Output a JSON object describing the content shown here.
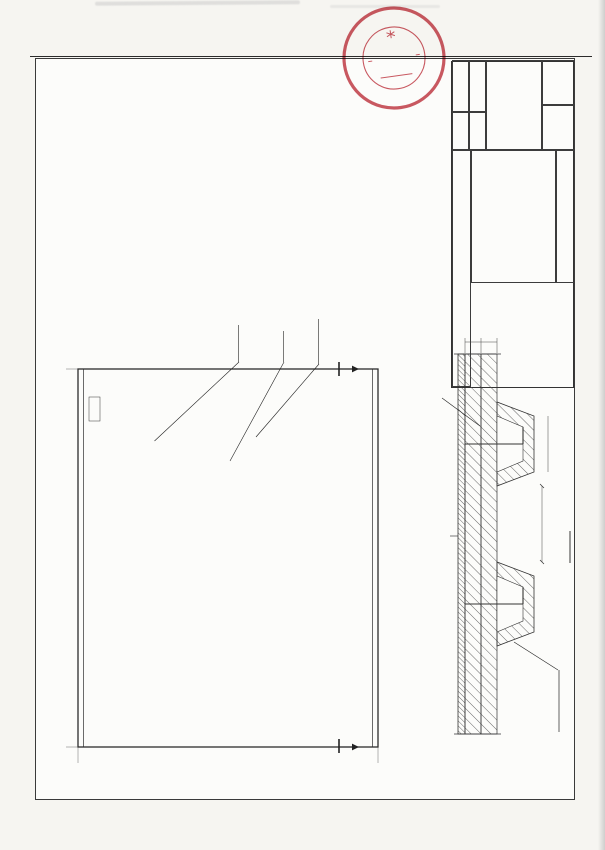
{
  "page": {
    "header_title": "Annex to the Certificate No.TA171235E(N)"
  },
  "stamp": {
    "arc_top": "NIPPON KAIJI KYOKAI",
    "arc_bottom": "ClassNK",
    "monogram": "NK",
    "color": "#c23b46"
  },
  "notes": {
    "lines": [
      "Description:",
      "1.Fireproof Materials:MJF-I Marine formaldehyde-free",
      "composite aluminum blanket,(3600*610*30)mm*Double,96Kg/m³.",
      "Fixed:When installing,fixed with welded pin and the two",
      "layers are staggered(joints),staggered-joints≥150mm.",
      "2.Welded pin specification:Φ3*80mm,Q235 Copper plating.",
      "Locking sheet:Φ30*0.1mm,Q235 Galvanized.",
      "3.Welded pin max spacing is 350mm,and maximum spacing from",
      "adjacent connection points is 150mm.Spacing with stiffeners",
      "is 100-150mm.",
      "4.Welded pin fixation:welding.Quality:17-21 sets/m².",
      "5.IMO.2010 FTP Annex 1 Part 3."
    ]
  },
  "plan": {
    "labels": {
      "outside_1": "Outside",
      "outside_2": "Joints",
      "inside_1": "Inside",
      "inside_2": "Joints",
      "welded_pin": "Welded pin"
    },
    "corners": {
      "top_left": "A",
      "top_right": "D",
      "bottom_left": "C",
      "bottom_right": "B"
    },
    "section_mark": "A",
    "dims": {
      "width_total": "3880",
      "height_total": "2480",
      "top_chain": [
        "150",
        "150",
        "250",
        "265",
        "325",
        "265",
        "325",
        "265",
        "325",
        "265",
        "250",
        "150",
        "150"
      ],
      "left_chain": [
        "40",
        "150",
        "200",
        "200",
        "250",
        "200",
        "200",
        "250",
        "200",
        "250",
        "200",
        "150",
        "150",
        "40"
      ],
      "local_top": "200",
      "local_top2": "150",
      "local_bottom": [
        "150",
        "500",
        "100"
      ]
    },
    "pins": {
      "col_fr": [
        0.018,
        0.098,
        0.178,
        0.258,
        0.338,
        0.418,
        0.498,
        0.578,
        0.658,
        0.738,
        0.818,
        0.898,
        0.982
      ],
      "row_fr": [
        0.016,
        0.07,
        0.158,
        0.245,
        0.332,
        0.418,
        0.5,
        0.582,
        0.668,
        0.755,
        0.842,
        0.93,
        0.984
      ]
    },
    "thermocouples": [
      {
        "n": "1",
        "x": 96,
        "y": 170
      },
      {
        "n": "2",
        "x": 322,
        "y": 96,
        "dim": "100"
      },
      {
        "n": "3",
        "x": 150,
        "y": 166
      },
      {
        "n": "4",
        "x": 205,
        "y": 158
      },
      {
        "n": "5",
        "x": 258,
        "y": 148,
        "dim": "130"
      },
      {
        "n": "6",
        "x": 136,
        "y": 104
      },
      {
        "n": "7",
        "x": 282,
        "y": 132
      },
      {
        "n": "8",
        "x": 242,
        "y": 110,
        "dim": "100"
      },
      {
        "n": "9",
        "x": 95,
        "y": 104
      }
    ]
  },
  "bom": {
    "headers": {
      "no": "No.",
      "model": "Model/Drawing",
      "name": "Name&Specification",
      "remarks": "Remarks"
    },
    "rows": [
      {
        "no": "11",
        "name": "Marine formaldehyde-free composite",
        "sub": "aluminum blanket 2x20mm"
      },
      {
        "no": "10",
        "name": "Welded pin:Φ3x80",
        "sub": "Locking sheet:Φ30x0.1 Q235"
      },
      {
        "no": "9",
        "name": "Temperature measuring point",
        "sub": "Thermocouple"
      },
      {
        "no": "8",
        "name": "Temperature measuring point",
        "sub": "Thermocouple"
      },
      {
        "no": "7",
        "name": "Temperature measuring point",
        "sub": "Thermocouple"
      },
      {
        "no": "6",
        "name": "Temperature measuring point",
        "sub": "Thermocouple"
      },
      {
        "no": "5",
        "name": "Temperature measuring point",
        "sub": "Thermocouple"
      },
      {
        "no": "4",
        "name": "Temperature measuring point",
        "sub": "Thermocouple"
      },
      {
        "no": "3",
        "name": "Temperature measuring point",
        "sub": "Thermocouple"
      },
      {
        "no": "2",
        "name": "Temperature measuring point",
        "sub": "Thermocouple"
      },
      {
        "no": "1",
        "name": "Temperature measuring point",
        "sub": "Thermocouple"
      }
    ]
  },
  "titleblock": {
    "company": "Wuxi MingJiang Insulation Materials Co., Ltd",
    "project_name_label": "Project name",
    "fire_test_label": "Fire Resistant test",
    "stage_label": "Stage",
    "drawing_title_line1": "A-60 Class",
    "drawing_title_line2": "Bulkhead Fire",
    "drawing_title_line3": "Test Drawing",
    "drawing_no": "MJF-I",
    "professional_label": "Professional",
    "page_label": "Page.",
    "total_label": "Total",
    "sig_table": {
      "col_responsibility": "Responsibility",
      "col_signature": "signature",
      "col_date": "Date",
      "rows": [
        {
          "role": "Design",
          "signature": "尤仁兴",
          "date": "2016.11.2"
        },
        {
          "role": "Mapping",
          "signature": "保海鹏",
          "date": "2016.11.2"
        },
        {
          "role": "Check",
          "signature": "尤仁兴",
          "date": "2016.11.2"
        },
        {
          "role": "Review",
          "signature": "薛军",
          "date": "2016.11.2"
        },
        {
          "role": "Approval",
          "signature": "",
          "date": ""
        }
      ]
    }
  },
  "section": {
    "title": "A-A",
    "fireside_label": "Fireside",
    "plate_label_1": "Ship plate thickness",
    "plate_label_2": "4.5±0.5mm",
    "stiffener_label": "65*65*6",
    "dims": {
      "layer1": "20",
      "layer2": "20",
      "between": "150",
      "bump": "100"
    }
  }
}
